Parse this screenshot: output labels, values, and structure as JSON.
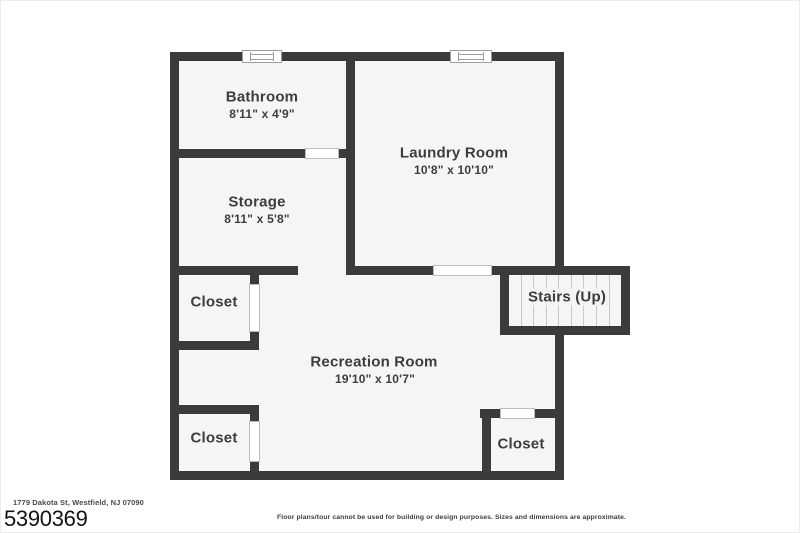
{
  "colors": {
    "wall": "#3b3b3b",
    "floor": "#f5f5f5",
    "background": "#ffffff",
    "label_text": "#3d3d3d",
    "tread_line": "#c9c9c9"
  },
  "rooms": {
    "bathroom": {
      "name": "Bathroom",
      "dims": "8'11\" x 4'9\""
    },
    "laundry": {
      "name": "Laundry Room",
      "dims": "10'8\" x 10'10\""
    },
    "storage": {
      "name": "Storage",
      "dims": "8'11\" x 5'8\""
    },
    "closet_upper_left": {
      "name": "Closet"
    },
    "stairs": {
      "name": "Stairs (Up)"
    },
    "recreation": {
      "name": "Recreation Room",
      "dims": "19'10\" x 10'7\""
    },
    "closet_lower_left": {
      "name": "Closet"
    },
    "closet_lower_right": {
      "name": "Closet"
    }
  },
  "footer": {
    "address": "1779 Dakota St, Westfield, NJ 07090",
    "listing_id": "5390369",
    "disclaimer": "Floor plans/tour cannot be used for building or design purposes. Sizes and dimensions are approximate."
  }
}
